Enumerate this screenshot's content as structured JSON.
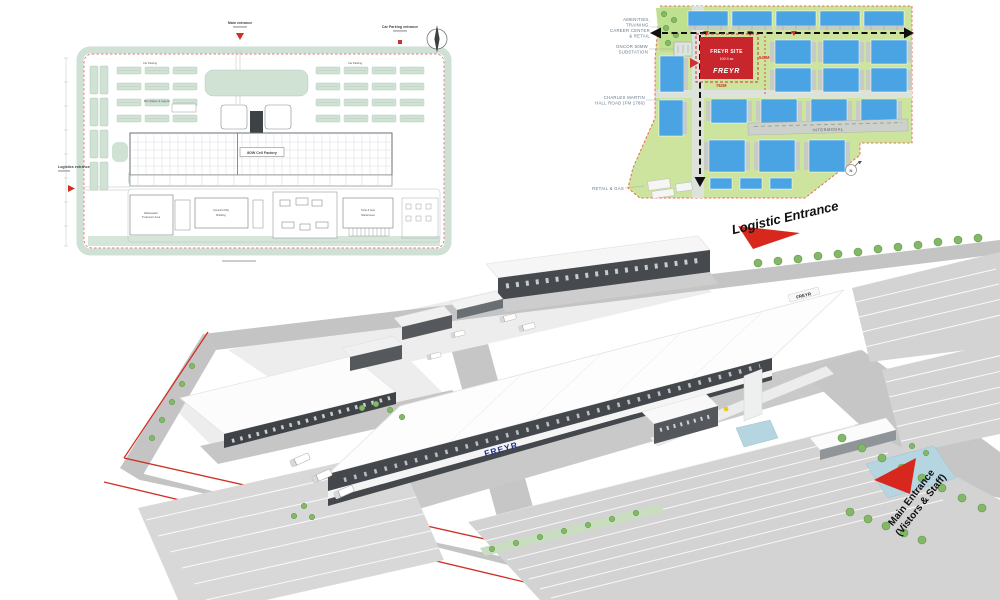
{
  "colors": {
    "freyr_red": "#c9252c",
    "arrow_red": "#d8281e",
    "freyr_blue": "#1e3191",
    "building_blue": "#4aa3e3",
    "land_green": "#cde49e"
  },
  "floor_plan": {
    "labels": {
      "main_entrance": "Main entrance",
      "car_parking_entrance": "Car Parking entrance",
      "logistics_entrance": "Logistics entrance",
      "car_parking_left": "Car Parking",
      "car_parking_right": "Car Parking",
      "bus_station": "Bus Station & Carport",
      "factory": "8GW Cell Factory",
      "wastewater_line1": "Wastewater",
      "wastewater_line2": "Treatment Area",
      "central_utility_line1": "Central Utility",
      "central_utility_line2": "Building",
      "tank_warehouse_line1": "Tank & Gas",
      "tank_warehouse_line2": "Warehouse"
    }
  },
  "master_plan": {
    "labels": {
      "amenities_lines": [
        "AMENITIES,",
        "TRAINING,",
        "CAREER CENTER",
        "& RETAIL"
      ],
      "substation_lines": [
        "ONCOR 60MW",
        "SUBSTATION"
      ],
      "road_lines": [
        "CHARLES MARTIN",
        "HALL ROAD (FM 1786)"
      ],
      "retail_gas": "RETAIL & GAS",
      "intermodal": "INTERMODAL",
      "north": "N"
    },
    "site": {
      "name": "FREYR SITE",
      "area": "100.9 ac",
      "logo": "FREYR"
    },
    "dims": {
      "width": "762M",
      "height": "549M"
    }
  },
  "render": {
    "labels": {
      "logistic_entrance": "Logistic Entrance",
      "main_entrance_line1": "Main Entrance",
      "main_entrance_line2": "(Vistors & Staff)"
    },
    "logos": {
      "facade": "FREYR",
      "roof_sign": "FREYR"
    }
  }
}
